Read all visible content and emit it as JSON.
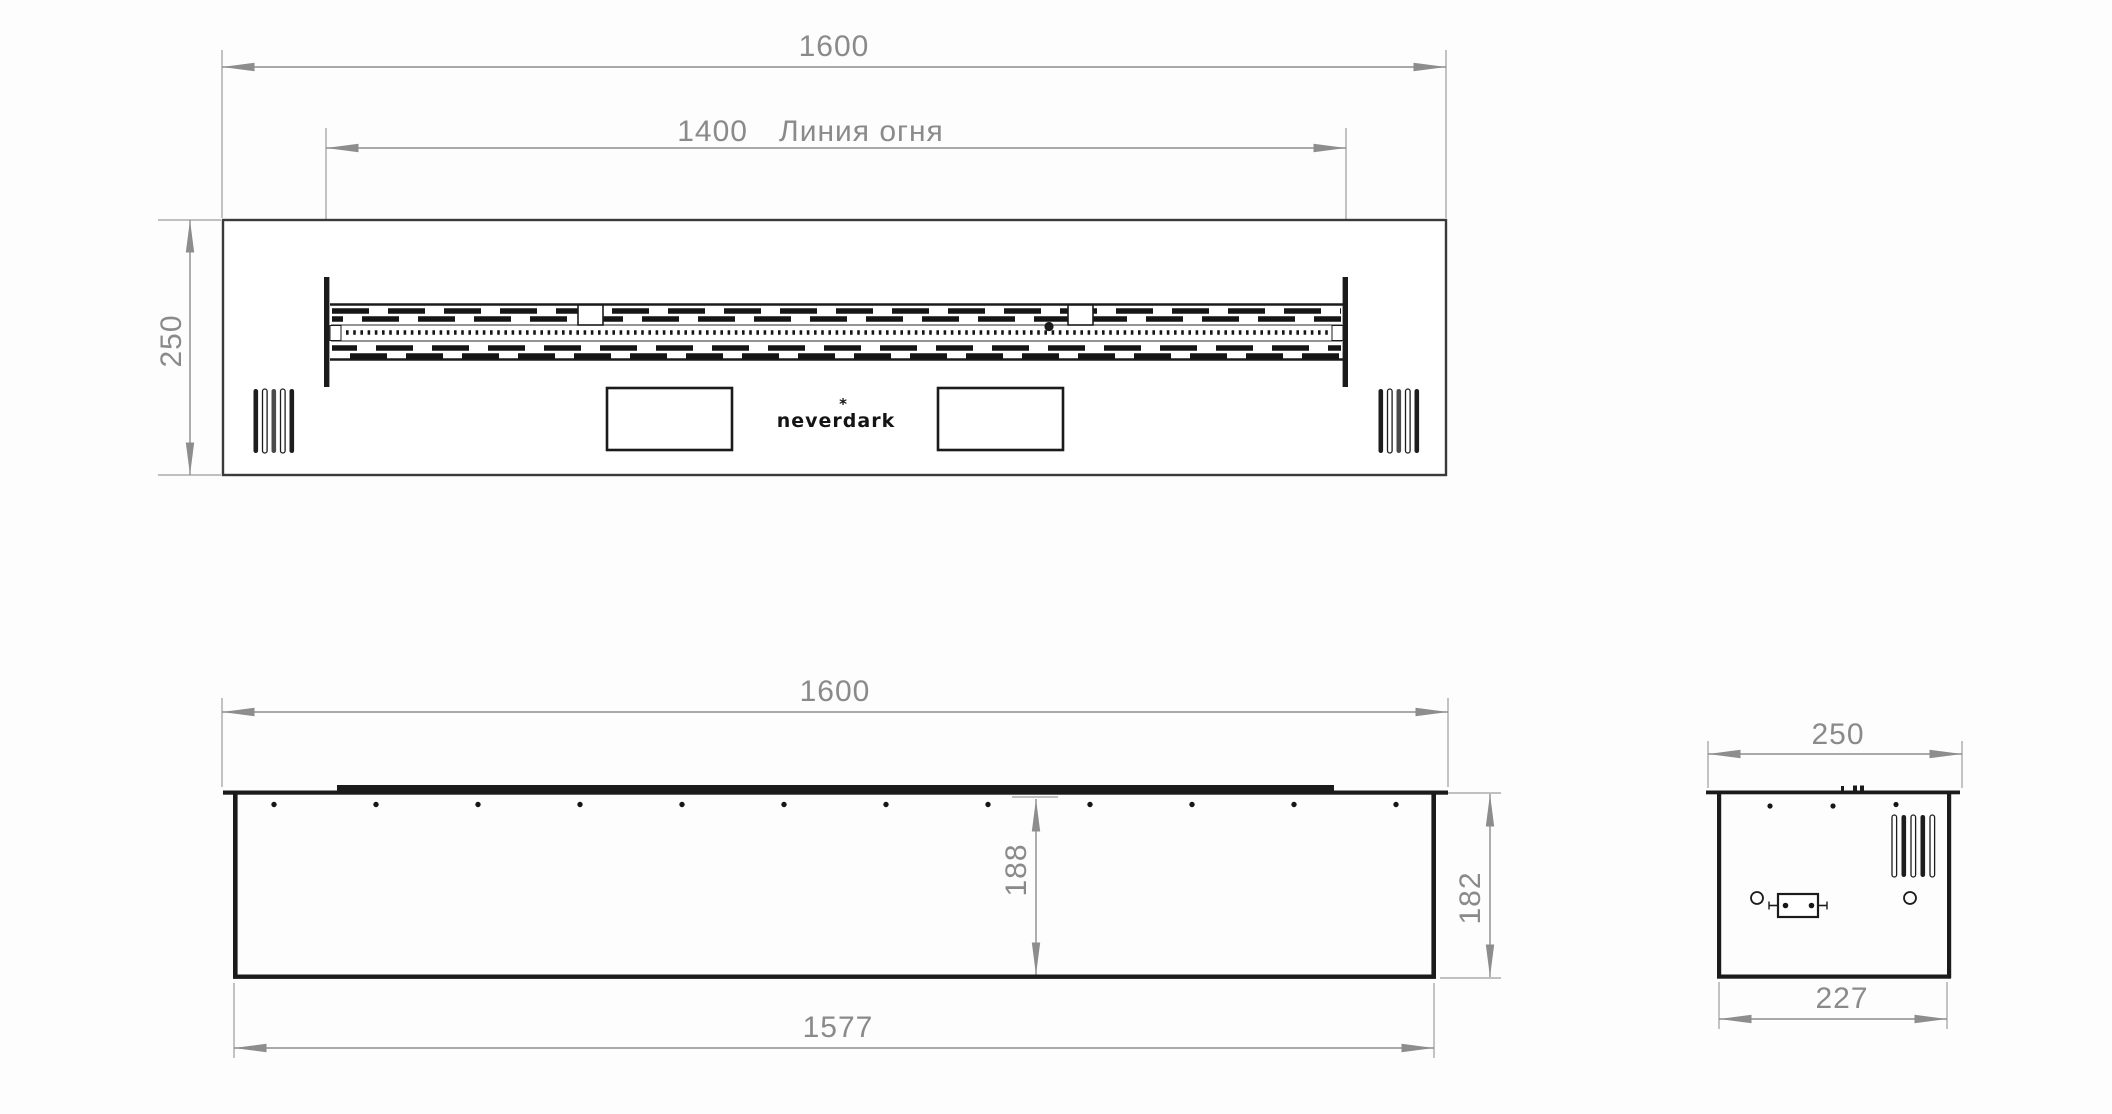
{
  "drawing": {
    "brand": {
      "logo": "neverdark",
      "logo_mark": "*"
    },
    "top_view": {
      "overall_width": "1600",
      "fire_line_value": "1400",
      "fire_line_label": "Линия огня",
      "depth": "250"
    },
    "front_view": {
      "overall_width": "1600",
      "bottom_width": "1577",
      "inner_height": "188",
      "body_height": "182"
    },
    "side_view": {
      "top_depth": "250",
      "bottom_depth": "227"
    },
    "colors": {
      "object_line": "#1b1b1b",
      "dimension_line": "#8d8d8d",
      "dimension_text": "#8a8a8a"
    }
  }
}
